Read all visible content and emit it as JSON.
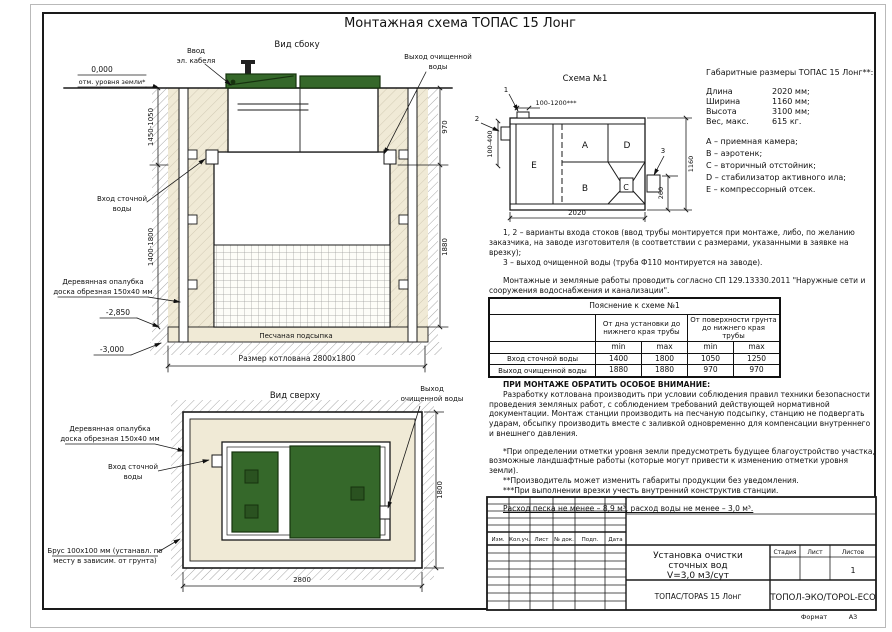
{
  "title": "Монтажная схема ТОПАС 15 Лонг",
  "colors": {
    "lid_green": "#35682a",
    "sand_beige": "#f0ead6",
    "line": "#1a1a1a"
  },
  "side_view": {
    "label": "Вид сбоку",
    "ground_mark": "0,000",
    "ground_mark_note": "отм. уровня земли*",
    "cable_l1": "Ввод",
    "cable_l2": "эл. кабеля",
    "outlet_l1": "Выход очищенной",
    "outlet_l2": "воды",
    "inlet_l1": "Вход сточной",
    "inlet_l2": "воды",
    "formwork_l1": "Деревянная опалубка",
    "formwork_l2": "доска обрезная 150х40 мм",
    "mark_2850": "-2,850",
    "mark_3000": "-3,000",
    "sand_label": "Песчаная подсыпка",
    "pit_size": "Размер котлована 2800х1800",
    "dim_left_top": "1450-1050",
    "dim_left_bottom": "1400-1800",
    "dim_right_top": "970",
    "dim_right_bottom": "1880"
  },
  "top_view": {
    "label": "Вид сверху",
    "outlet_l1": "Выход",
    "outlet_l2": "очищенной воды",
    "formwork_l1": "Деревянная опалубка",
    "formwork_l2": "доска обрезная 150х40 мм",
    "inlet_l1": "Вход сточной",
    "inlet_l2": "воды",
    "beam_l1": "Брус 100х100 мм (устанавл. по",
    "beam_l2": "месту в зависим. от грунта)",
    "dim_right": "1800",
    "dim_bottom": "2800"
  },
  "scheme": {
    "label": "Схема №1",
    "callout_1": "1",
    "callout_2": "2",
    "callout_3": "3",
    "dim_top": "100-1200***",
    "dim_left": "100-400",
    "dim_right": "1160",
    "dim_outlet": "260",
    "dim_bottom": "2020",
    "letters": [
      "A",
      "B",
      "C",
      "D",
      "E"
    ]
  },
  "specs": {
    "heading": "Габаритные размеры ТОПАС 15 Лонг**:",
    "rows": [
      [
        "Длина",
        "2020 мм;"
      ],
      [
        "Ширина",
        "1160 мм;"
      ],
      [
        "Высота",
        "3100 мм;"
      ],
      [
        "Вес, макс.",
        "615 кг."
      ]
    ],
    "legend": [
      "А – приемная камера;",
      "В – аэротенк;",
      "С – вторичный отстойник;",
      "D – стабилизатор активного ила;",
      "Е – компрессорный отсек."
    ]
  },
  "notes": {
    "p1": "1, 2 – варианты входа стоков (ввод трубы монтируется при монтаже, либо, по желанию заказчика, на заводе изготовителя (в соответствии с размерами, указанными в заявке на врезку);",
    "p2": "3 – выход очищенной воды (труба Ф110 монтируется на заводе).",
    "p3": "Монтажные и земляные работы проводить согласно СП 129.13330.2011 \"Наружные сети и сооружения водоснабжения и канализации\"."
  },
  "table": {
    "title": "Пояснение к схеме №1",
    "col_group1": "От дна установки до нижнего края трубы",
    "col_group2": "От поверхности грунта до нижнего края трубы",
    "min": "min",
    "max": "max",
    "rows": [
      {
        "label": "Вход сточной воды",
        "v1": "1400",
        "v2": "1800",
        "v3": "1050",
        "v4": "1250"
      },
      {
        "label": "Выход очищенной воды",
        "v1": "1880",
        "v2": "1880",
        "v3": "970",
        "v4": "970"
      }
    ]
  },
  "warning": {
    "heading": "ПРИ МОНТАЖЕ ОБРАТИТЬ ОСОБОЕ ВНИМАНИЕ:",
    "body": "Разработку котлована производить при условии соблюдения правил техники безопасности проведения земляных работ, с соблюдением требований действующей нормативной документации. Монтаж станции производить на песчаную подсыпку, станцию не подвергать ударам, обсыпку производить вместе с заливкой одновременно для компенсации внутреннего и внешнего давления.",
    "note1": "*При определении отметки уровня земли предусмотреть будущее благоустройство участка, возможные ландшафтные работы (которые могут привести к изменению отметки уровня земли).",
    "note2": "**Производитель может изменить габариты продукции без уведомления.",
    "note3": "***При выполнении врезки учесть внутренний конструктив станции.",
    "consumption": "Расход песка не менее – 8,9 м³, расход воды не менее – 3,0 м³."
  },
  "title_block": {
    "cols": [
      "Изм.",
      "Кол.уч.",
      "Лист",
      "№ док.",
      "Подп.",
      "Дата"
    ],
    "doc_l1": "Установка очистки",
    "doc_l2": "сточных вод",
    "doc_l3": "V=3,0 м3/сут",
    "model": "ТОПАС/TOPAS 15 Лонг",
    "stage": "Стадия",
    "sheet": "Лист",
    "sheets": "Листов",
    "sheets_value": "1",
    "company": "ТОПОЛ-ЭКО/TOPOL-ECO",
    "format_label": "Формат",
    "format_value": "А3"
  }
}
